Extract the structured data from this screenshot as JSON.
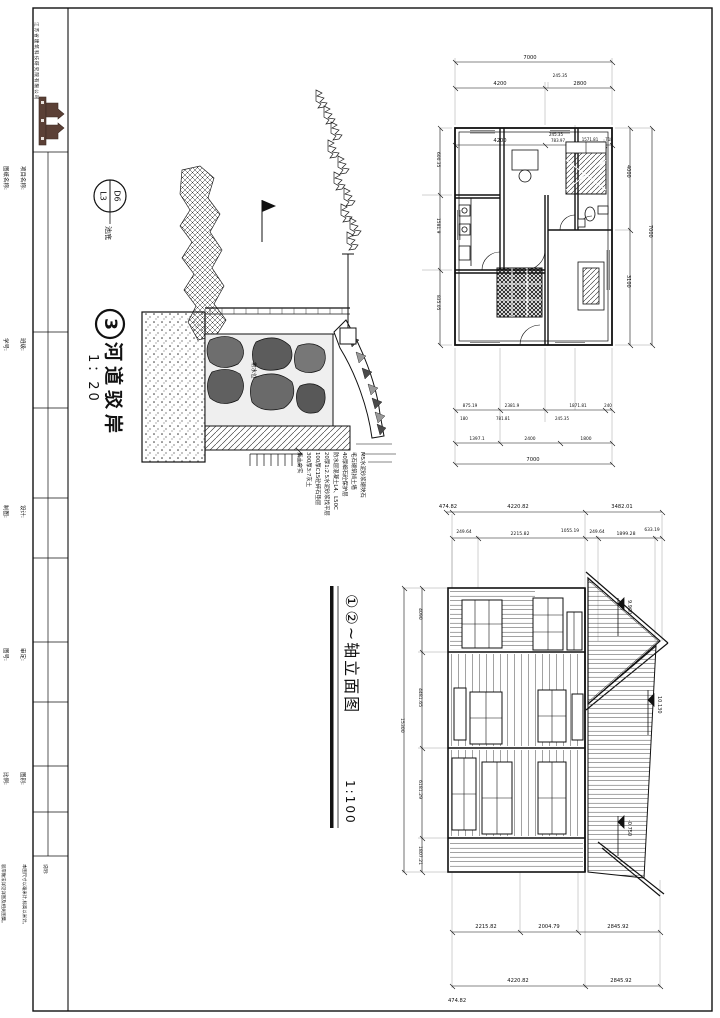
{
  "sheet": {
    "company": "江苏省建筑科技研究院有限公司",
    "titleblock": {
      "project_label": "项目名称:",
      "project_sub": "PROJECT",
      "title_label": "图纸名称:",
      "title_sub": "TITLE",
      "class_label": "班级:",
      "class_value": "JI-224-Z",
      "id_label": "学号:",
      "id_value": "24AG5B30203",
      "design_label": "设计:",
      "design_sub": "DESIGNER",
      "draw_label": "制图:",
      "draw_sub": "DRAWING",
      "approve_label": "审定:",
      "approve_sub": "APPROVER",
      "dwgno_label": "图号:",
      "dwgno_sub": "DWG NO.",
      "type_label": "图别:",
      "type_value": "G-17",
      "scale_label": "比例:",
      "scale_value": "1:100",
      "notes_title": "说明:",
      "note1": "本图尺寸以毫米计,标高以米计。",
      "note2": "驳岸做法详见详图及相关图集。",
      "note3": "未尽事宜按国家现行规范执行。"
    }
  },
  "detail": {
    "bubble_top": "D6",
    "bubble_bottom": "L3",
    "bubble_label": "池底",
    "number": "3",
    "title": "河道驳岸",
    "scale": "1：20",
    "water_label": "常水位",
    "notes": "M5水泥砂浆砌块石\n毛石砌筑挡土墙\n40厚细石砼保护层\n防水层混凝土L4、L50C\n20厚1:2.5水泥砂浆找平层\n100厚C15砼碎石垫层\n300厚3:7灰土\n素土夯实"
  },
  "plan": {
    "t1": "7000",
    "t2a": "4200",
    "t2b": "245.35",
    "t2c": "2800",
    "t3a": "4200",
    "t3b": "245.35",
    "t3c": "783.97",
    "t3d": "1571.81",
    "t3e": "718",
    "l1": "600.35",
    "l2": "1581.9",
    "l3": "835.05",
    "r1": "4000",
    "r2": "3100",
    "r3": "7000",
    "b1a": "875.19",
    "b1b": "2381.9",
    "b1c": "1871.81",
    "b1d": "240",
    "b2a": "180",
    "b2b": "781.81",
    "b2c": "245.35",
    "b3a": "1397.1",
    "b3b": "2400",
    "b3c": "1800",
    "b4": "7000"
  },
  "elevation": {
    "title": "①②~轴立面图",
    "scale": "1:100",
    "t1": "474.82",
    "t2": "4220.82",
    "t3": "3482.01",
    "s1": "249.64",
    "s2": "2215.82",
    "s3": "1055.19",
    "s4": "249.64",
    "s5": "1899.28",
    "s6": "633.19",
    "lv1": "9.900",
    "lv2": "10.130",
    "lv3": "-0.750",
    "d1": "4090",
    "d2": "4481.65",
    "d3": "6181.29",
    "d4": "1807.21",
    "dt": "15300",
    "b1": "2215.82",
    "b2": "2004.79",
    "b3": "2845.92",
    "c1": "4220.82",
    "c2": "2845.92",
    "corner": "474.82"
  }
}
